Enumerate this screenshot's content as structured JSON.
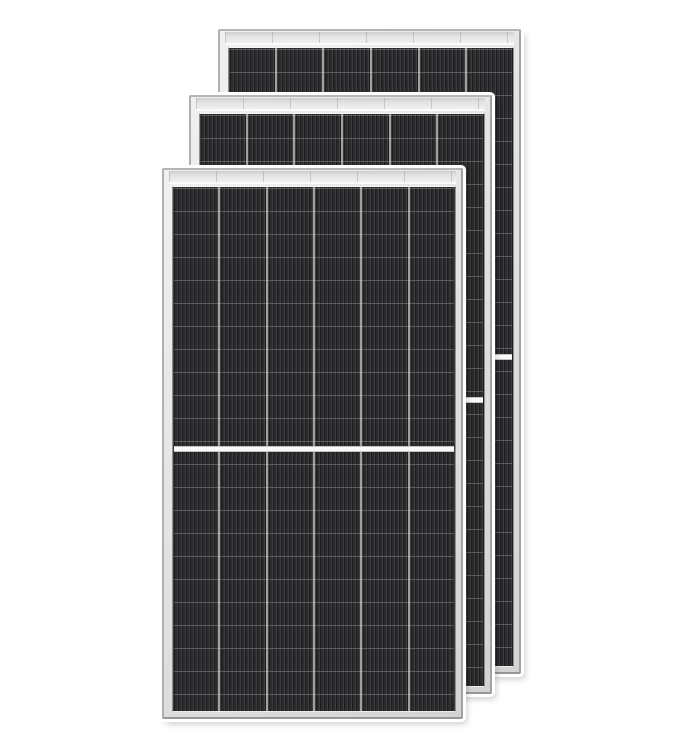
{
  "canvas": {
    "width": 684,
    "height": 748,
    "background": "#ffffff"
  },
  "product": {
    "name": "solar-panel-stack",
    "panel_count": 3
  },
  "panels": [
    {
      "name": "back-panel",
      "columns": 6,
      "rows_per_half": 13,
      "half_cut": true
    },
    {
      "name": "middle-panel",
      "columns": 6,
      "rows_per_half": 12,
      "half_cut": true
    },
    {
      "name": "front-panel",
      "columns": 6,
      "rows_per_half": 11,
      "half_cut": true
    }
  ],
  "colors": {
    "background": "#ffffff",
    "frame_fill": "#e1e1e1",
    "frame_edge": "#a2a2a2",
    "frame_highlight": "#fbfbfb",
    "cell_base": "#28282a",
    "cell_stripe_light": "#3d3d3f",
    "cell_stripe_dark": "#1e1e20",
    "column_divider": "#a0a0a0",
    "row_line": "#e4e4e9",
    "half_cut_divider": "#fafafa"
  }
}
